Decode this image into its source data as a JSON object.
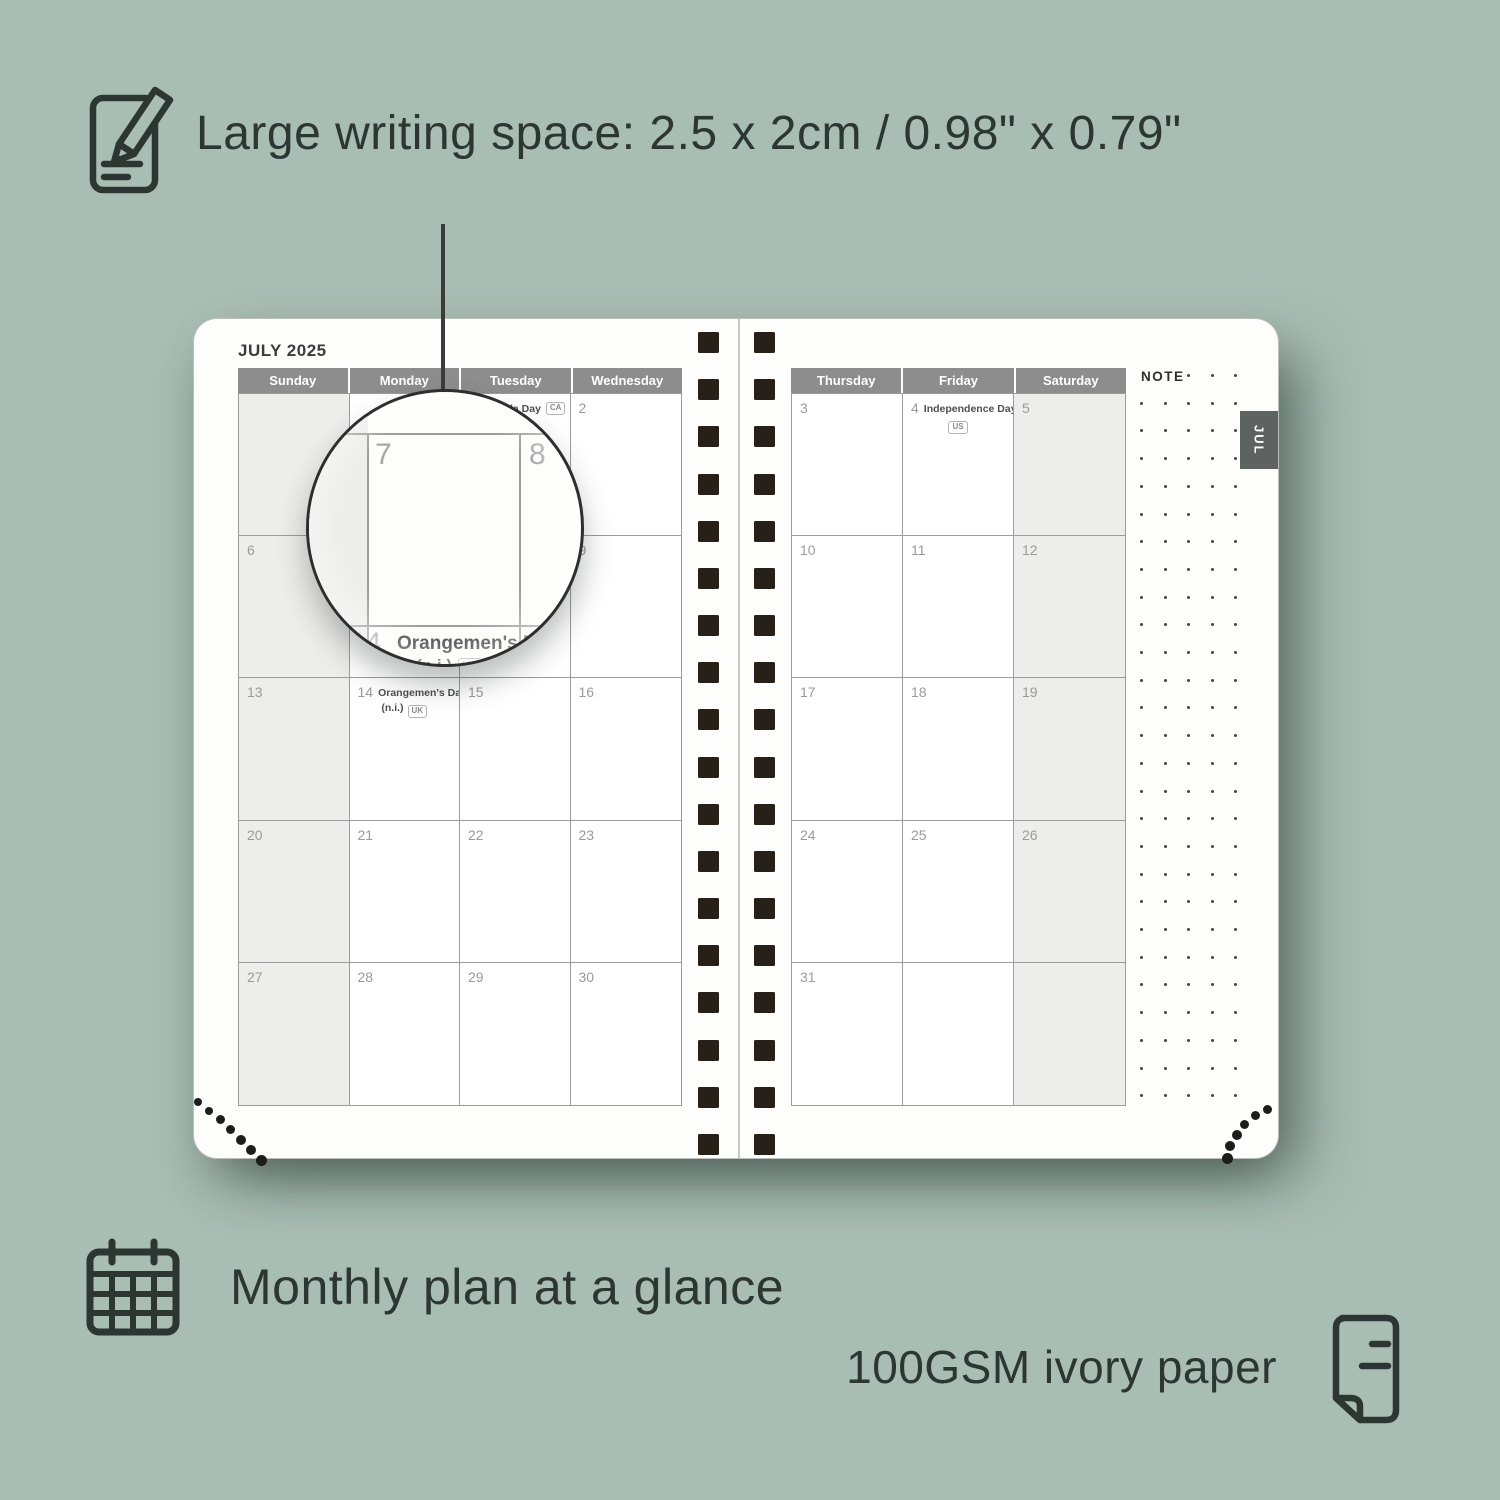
{
  "colors": {
    "background": "#a8bdb3",
    "text_dark": "#2c3632",
    "header_gray": "#8d8d8d",
    "weekend_cell": "#ededeb",
    "grid_line": "#9c9c9c",
    "date_number": "#9a9a9a",
    "spiral_square": "#262019",
    "tab_bg": "#5e6361",
    "page": "#fdfdfb"
  },
  "captions": {
    "writing_space": "Large writing space: 2.5 x 2cm / 0.98\" x 0.79\"",
    "monthly_plan": "Monthly plan at a glance",
    "paper": "100GSM ivory paper"
  },
  "planner": {
    "title": "JULY 2025",
    "tab": "JUL",
    "note": "NOTE",
    "left_headers": [
      "Sunday",
      "Monday",
      "Tuesday",
      "Wednesday"
    ],
    "right_headers": [
      "Thursday",
      "Friday",
      "Saturday"
    ],
    "left_rows": [
      [
        {},
        {},
        {
          "d": "1",
          "h": "Canada Day",
          "b": "CA",
          "inline": true
        },
        {
          "d": "2"
        }
      ],
      [
        {
          "d": "6"
        },
        {
          "d": "7"
        },
        {
          "d": "8"
        },
        {
          "d": "9"
        }
      ],
      [
        {
          "d": "13"
        },
        {
          "d": "14",
          "h": "Orangemen's Day",
          "h2": "(n.i.)",
          "b": "UK"
        },
        {
          "d": "15"
        },
        {
          "d": "16"
        }
      ],
      [
        {
          "d": "20"
        },
        {
          "d": "21"
        },
        {
          "d": "22"
        },
        {
          "d": "23"
        }
      ],
      [
        {
          "d": "27"
        },
        {
          "d": "28"
        },
        {
          "d": "29"
        },
        {
          "d": "30"
        }
      ]
    ],
    "right_rows": [
      [
        {
          "d": "3"
        },
        {
          "d": "4",
          "h": "Independence Day",
          "b": "US"
        },
        {
          "d": "5"
        }
      ],
      [
        {
          "d": "10"
        },
        {
          "d": "11"
        },
        {
          "d": "12"
        }
      ],
      [
        {
          "d": "17"
        },
        {
          "d": "18"
        },
        {
          "d": "19"
        }
      ],
      [
        {
          "d": "24"
        },
        {
          "d": "25"
        },
        {
          "d": "26"
        }
      ],
      [
        {
          "d": "31"
        },
        {},
        {}
      ]
    ],
    "magnifier": {
      "day_left": "7",
      "day_right": "8",
      "day_bottom": "14",
      "holiday": "Orangemen's Day",
      "holiday_line2": "(n.i.)",
      "badge": "UK"
    }
  }
}
